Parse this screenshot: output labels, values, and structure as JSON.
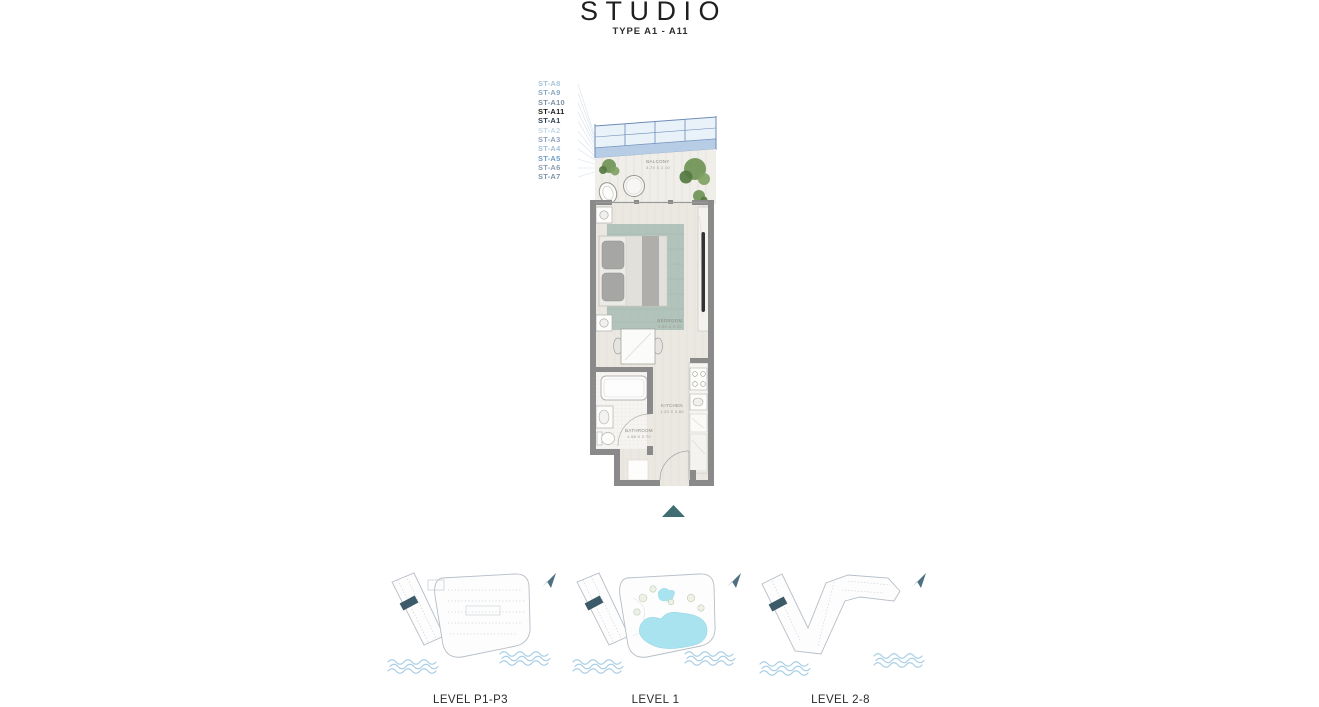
{
  "header": {
    "title": "STUDIO",
    "subtitle": "TYPE A1 - A11"
  },
  "unit_labels": [
    {
      "id": "ST-A8",
      "color": "#a9c6da",
      "bold": false
    },
    {
      "id": "ST-A9",
      "color": "#8ba7bf",
      "bold": false
    },
    {
      "id": "ST-A10",
      "color": "#7e92a5",
      "bold": false
    },
    {
      "id": "ST-A11",
      "color": "#1c1c1a",
      "bold": true
    },
    {
      "id": "ST-A1",
      "color": "#2f3f4d",
      "bold": true
    },
    {
      "id": "ST-A2",
      "color": "#c6d9e6",
      "bold": false
    },
    {
      "id": "ST-A3",
      "color": "#90a4b9",
      "bold": false
    },
    {
      "id": "ST-A4",
      "color": "#a5c1d7",
      "bold": false
    },
    {
      "id": "ST-A5",
      "color": "#6fa0c7",
      "bold": false
    },
    {
      "id": "ST-A6",
      "color": "#8c9dae",
      "bold": false
    },
    {
      "id": "ST-A7",
      "color": "#7e94a9",
      "bold": false
    }
  ],
  "floorplan": {
    "balcony": {
      "name": "BALCONY",
      "dims": "3.70 X 2.10"
    },
    "bedroom": {
      "name": "BEDROOM",
      "dims": "3.50 X 5.20"
    },
    "kitchen": {
      "name": "KITCHEN",
      "dims": "1.20 X 3.80"
    },
    "bathroom": {
      "name": "BATHROOM",
      "dims": "1.58 X 2.70"
    }
  },
  "level_maps": [
    {
      "label": "LEVEL P1-P3"
    },
    {
      "label": "LEVEL 1"
    },
    {
      "label": "LEVEL 2-8"
    }
  ],
  "colors": {
    "accent": "#3f6d72",
    "highlight": "#3c5a68",
    "wall": "#8a8a8a",
    "glass": "#e9f1f9",
    "glassband": "#b7cde6",
    "glassframe": "#6b8cb8",
    "pool": "#a8e3ef",
    "water": "#a9cfe5",
    "rug": "#abbfb7",
    "plant": "#6f9355",
    "floor": "#ebe8e2",
    "deck": "#f0eee9"
  }
}
